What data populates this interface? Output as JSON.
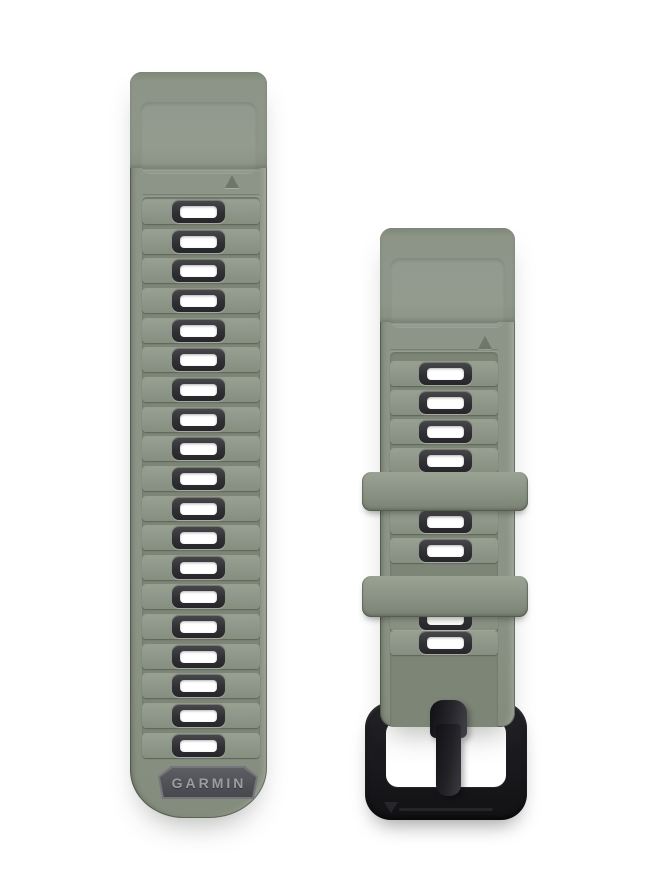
{
  "canvas": {
    "width": 660,
    "height": 890,
    "background": "#ffffff"
  },
  "brand": {
    "badge_text": "GARMIN"
  },
  "colors": {
    "background": "#ffffff",
    "strap_green": "#8c9487",
    "strap_green_dark": "#7d8577",
    "strap_green_light": "#99a192",
    "slot_frame": "#323236",
    "slot_hole": "#ffffff",
    "badge_bg": "#53555a",
    "badge_rim": "#74767b",
    "badge_text_color": "#9b9da0",
    "buckle_black": "#1c1c20",
    "marker_green": "#6f7767"
  },
  "left_strap": {
    "x": 130,
    "y": 72,
    "width": 137,
    "height": 746,
    "topblock_height": 96,
    "band_left": 12,
    "band_width": 118,
    "ridge_zone": {
      "top": 125,
      "height": 562
    },
    "grooves_y": [
      96,
      122
    ],
    "slots": {
      "count": 19,
      "first_center_y": 212,
      "pitch": 29.65,
      "center_x": 198
    },
    "triangle_marker": {
      "x": 225,
      "y": 175,
      "direction": "up"
    },
    "badge": {
      "x": 158,
      "y": 766,
      "width": 100,
      "height": 33
    }
  },
  "right_strap": {
    "x": 380,
    "y": 228,
    "width": 135,
    "height": 499,
    "topblock_height": 94,
    "band_left": 10,
    "band_width": 108,
    "ridge_zone": {
      "top": 124,
      "height": 432
    },
    "grooves_y": [
      94,
      121
    ],
    "slot_centers_y": [
      374,
      403,
      432,
      461,
      522,
      551,
      619,
      643
    ],
    "slot_center_x": 445,
    "triangle_marker": {
      "x": 478,
      "y": 336,
      "direction": "up"
    },
    "keepers": [
      {
        "x": 362,
        "y": 472,
        "width": 166,
        "height": 39
      },
      {
        "x": 362,
        "y": 576,
        "width": 166,
        "height": 41
      }
    ],
    "buckle": {
      "x": 365,
      "y": 702,
      "width": 162,
      "height": 118,
      "prong": {
        "x": 430,
        "y": 700,
        "width": 37,
        "height": 96
      },
      "triangle_marker": {
        "x": 384,
        "y": 802,
        "direction": "down"
      }
    }
  }
}
